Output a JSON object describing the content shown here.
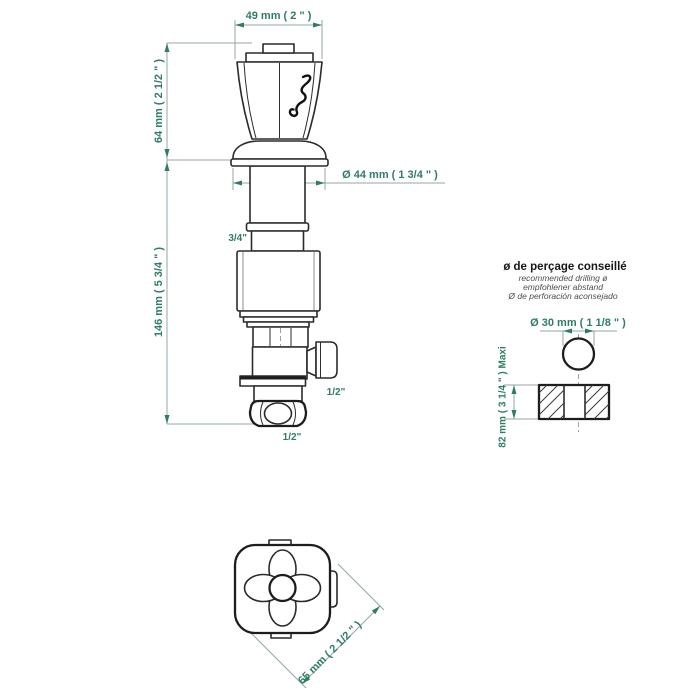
{
  "colors": {
    "dimension_text_green": "#2e7d64",
    "dimension_line_gray": "#93a89f",
    "part_outline": "#2b2b2b",
    "background": "#ffffff"
  },
  "front_view": {
    "dim_handle_top_width": "49 mm ( 2 \" )",
    "dim_handle_height": "64 mm ( 2 1/2 \" )",
    "dim_body_height": "146 mm ( 5 3/4 \" )",
    "dim_skirt_diameter": "Ø 44 mm ( 1 3/4 \" )",
    "thread_stem": "3/4\"",
    "thread_side_outlet": "1/2\"",
    "thread_bottom_inlet": "1/2\""
  },
  "drilling_note": {
    "title": "ø de perçage conseillé",
    "subtitle_en": "recommended drilling ø",
    "subtitle_de": "empfohlener abstand",
    "subtitle_es": "Ø de perforación aconsejado",
    "dim_hole_diameter": "Ø 30 mm ( 1 1/8 \" )",
    "dim_deck_thickness_max": "82 mm ( 3 1/4 \" )  Maxi"
  },
  "top_view": {
    "dim_handle_diagonal": "65 mm ( 2 1/2 \" )"
  }
}
